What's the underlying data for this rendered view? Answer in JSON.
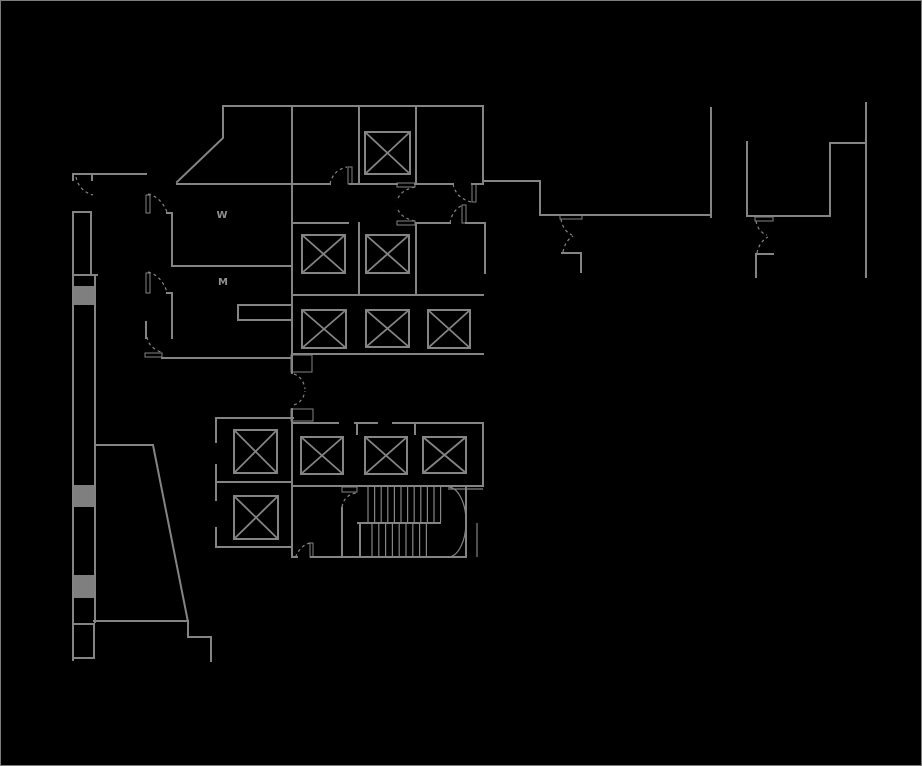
{
  "drawing": {
    "canvas": {
      "width": 922,
      "height": 766,
      "background": "#000000",
      "border_color": "#7c7c7c"
    },
    "style": {
      "wall_color": "#848484",
      "wall_width": 2,
      "thin_width": 1.2,
      "column_fill": "#7f7f7f",
      "dash_pattern": "3,3",
      "label_color": "#8f8f8f",
      "label_size": 10
    },
    "labels": [
      {
        "text": "W",
        "x": 222,
        "y": 218
      },
      {
        "text": "M",
        "x": 223,
        "y": 285
      }
    ],
    "walls": [
      [
        [
          177,
          182
        ],
        [
          223,
          138
        ],
        [
          223,
          106
        ],
        [
          483,
          106
        ]
      ],
      [
        [
          292,
          106
        ],
        [
          292,
          373
        ]
      ],
      [
        [
          359,
          106
        ],
        [
          359,
          184
        ]
      ],
      [
        [
          416,
          106
        ],
        [
          416,
          184
        ]
      ],
      [
        [
          483,
          106
        ],
        [
          483,
          183
        ]
      ],
      [
        [
          177,
          184
        ],
        [
          330,
          184
        ]
      ],
      [
        [
          350,
          184
        ],
        [
          397,
          184
        ]
      ],
      [
        [
          415,
          184
        ],
        [
          453,
          184
        ]
      ],
      [
        [
          472,
          184
        ],
        [
          483,
          184
        ]
      ],
      [
        [
          483,
          181
        ],
        [
          540,
          181
        ],
        [
          540,
          215
        ],
        [
          711,
          215
        ]
      ],
      [
        [
          711,
          108
        ],
        [
          711,
          217
        ]
      ],
      [
        [
          747,
          142
        ],
        [
          747,
          216
        ],
        [
          830,
          216
        ],
        [
          830,
          143
        ],
        [
          866,
          143
        ]
      ],
      [
        [
          866,
          103
        ],
        [
          866,
          277
        ]
      ],
      [
        [
          562,
          253
        ],
        [
          581,
          253
        ],
        [
          581,
          272
        ]
      ],
      [
        [
          773,
          254
        ],
        [
          756,
          254
        ],
        [
          756,
          277
        ]
      ],
      [
        [
          292,
          223
        ],
        [
          348,
          223
        ]
      ],
      [
        [
          417,
          223
        ],
        [
          450,
          223
        ]
      ],
      [
        [
          466,
          223
        ],
        [
          485,
          223
        ],
        [
          485,
          273
        ]
      ],
      [
        [
          359,
          223
        ],
        [
          359,
          295
        ]
      ],
      [
        [
          416,
          223
        ],
        [
          416,
          295
        ]
      ],
      [
        [
          292,
          295
        ],
        [
          483,
          295
        ]
      ],
      [
        [
          292,
          354
        ],
        [
          483,
          354
        ]
      ],
      [
        [
          167,
          213
        ],
        [
          172,
          213
        ],
        [
          172,
          266
        ]
      ],
      [
        [
          172,
          266
        ],
        [
          292,
          266
        ]
      ],
      [
        [
          167,
          293
        ],
        [
          172,
          293
        ],
        [
          172,
          338
        ]
      ],
      [
        [
          146,
          322
        ],
        [
          146,
          338
        ]
      ],
      [
        [
          162,
          358
        ],
        [
          292,
          358
        ]
      ],
      [
        [
          292,
          305
        ],
        [
          238,
          305
        ],
        [
          238,
          320
        ],
        [
          292,
          320
        ]
      ],
      [
        [
          73,
          180
        ],
        [
          73,
          174
        ],
        [
          92,
          174
        ],
        [
          92,
          180
        ]
      ],
      [
        [
          92,
          174
        ],
        [
          146,
          174
        ]
      ],
      [
        [
          73,
          212
        ],
        [
          91,
          212
        ]
      ],
      [
        [
          73,
          212
        ],
        [
          73,
          660
        ]
      ],
      [
        [
          91,
          212
        ],
        [
          91,
          275
        ]
      ],
      [
        [
          73,
          275
        ],
        [
          97,
          275
        ]
      ],
      [
        [
          95,
          275
        ],
        [
          95,
          622
        ]
      ],
      [
        [
          73,
          624
        ],
        [
          94,
          624
        ]
      ],
      [
        [
          94,
          624
        ],
        [
          94,
          658
        ]
      ],
      [
        [
          73,
          658
        ],
        [
          94,
          658
        ]
      ],
      [
        [
          95,
          445
        ],
        [
          153,
          445
        ]
      ],
      [
        [
          153,
          445
        ],
        [
          188,
          622
        ]
      ],
      [
        [
          94,
          621
        ],
        [
          188,
          621
        ]
      ],
      [
        [
          188,
          621
        ],
        [
          188,
          637
        ],
        [
          211,
          637
        ],
        [
          211,
          661
        ]
      ],
      [
        [
          293,
          418
        ],
        [
          216,
          418
        ],
        [
          216,
          442
        ]
      ],
      [
        [
          216,
          465
        ],
        [
          216,
          500
        ]
      ],
      [
        [
          216,
          528
        ],
        [
          216,
          547
        ],
        [
          292,
          547
        ]
      ],
      [
        [
          216,
          482
        ],
        [
          292,
          482
        ]
      ],
      [
        [
          292,
          409
        ],
        [
          292,
          557
        ]
      ],
      [
        [
          292,
          423
        ],
        [
          338,
          423
        ]
      ],
      [
        [
          355,
          423
        ],
        [
          377,
          423
        ]
      ],
      [
        [
          393,
          423
        ],
        [
          483,
          423
        ]
      ],
      [
        [
          357,
          423
        ],
        [
          357,
          434
        ]
      ],
      [
        [
          415,
          423
        ],
        [
          415,
          434
        ]
      ],
      [
        [
          483,
          423
        ],
        [
          483,
          486
        ]
      ],
      [
        [
          292,
          486
        ],
        [
          483,
          486
        ]
      ],
      [
        [
          292,
          557
        ],
        [
          297,
          557
        ]
      ],
      [
        [
          311,
          557
        ],
        [
          466,
          557
        ]
      ],
      [
        [
          466,
          486
        ],
        [
          466,
          557
        ]
      ],
      [
        [
          342,
          508
        ],
        [
          342,
          557
        ]
      ],
      [
        [
          358,
          523
        ],
        [
          440,
          523
        ]
      ],
      [
        [
          360,
          523
        ],
        [
          360,
          557
        ]
      ]
    ],
    "thin_lines": [
      [
        [
          448,
          489
        ],
        [
          483,
          489
        ]
      ],
      [
        [
          477,
          523
        ],
        [
          477,
          557
        ]
      ]
    ],
    "door_frames": [
      [
        146,
        195,
        4,
        18
      ],
      [
        146,
        273,
        4,
        20
      ],
      [
        145,
        353,
        17,
        4
      ],
      [
        348,
        167,
        4,
        17
      ],
      [
        472,
        184,
        4,
        18
      ],
      [
        462,
        205,
        4,
        18
      ],
      [
        397,
        183,
        18,
        4
      ],
      [
        397,
        221,
        18,
        4
      ],
      [
        291,
        355,
        21,
        17
      ],
      [
        291,
        409,
        22,
        12
      ],
      [
        560,
        215,
        22,
        4
      ],
      [
        755,
        217,
        18,
        4
      ],
      [
        342,
        487,
        15,
        5
      ],
      [
        310,
        543,
        3,
        14
      ]
    ],
    "columns": [
      [
        73,
        286,
        22,
        19
      ],
      [
        73,
        485,
        22,
        22
      ],
      [
        73,
        575,
        22,
        23
      ]
    ],
    "elevators": [
      [
        365,
        132,
        45,
        42
      ],
      [
        302,
        235,
        43,
        38
      ],
      [
        366,
        235,
        43,
        38
      ],
      [
        302,
        310,
        44,
        38
      ],
      [
        366,
        310,
        43,
        37
      ],
      [
        428,
        310,
        42,
        38
      ],
      [
        234,
        430,
        43,
        43
      ],
      [
        234,
        496,
        44,
        43
      ],
      [
        301,
        437,
        42,
        37
      ],
      [
        365,
        437,
        42,
        37
      ],
      [
        423,
        437,
        43,
        36
      ]
    ],
    "door_arcs_dashed": [
      "M 76 177 Q 79 191 93 195",
      "M 148 194 Q 161 197 167 212",
      "M 148 272 Q 161 275 167 292",
      "M 147 337 Q 149 348 161 352",
      "M 330 184 Q 333 170 347 167",
      "M 453 184 Q 456 198 471 202",
      "M 450 223 Q 452 211 461 206",
      "M 415 187 Q 400 190 397 201",
      "M 415 221 Q 400 218 397 207",
      "M 294 374 Q 303 377 305 389",
      "M 294 405 Q 303 402 305 391",
      "M 561 219 Q 563 231 572 235",
      "M 563 252 Q 565 241 573 236",
      "M 756 221 Q 758 232 767 235",
      "M 757 253 Q 759 242 768 237",
      "M 342 507 Q 344 495 356 493",
      "M 310 543 Q 301 545 296 556"
    ],
    "door_arcs_solid": [
      "M 448 487 A 18 35 0 0 1 448 557"
    ],
    "stairs": [
      {
        "x0": 368,
        "dx": 6.6,
        "n": 11,
        "y1": 487,
        "y2": 522
      },
      {
        "x0": 372,
        "dx": 6.8,
        "n": 8,
        "y1": 524,
        "y2": 556
      }
    ]
  }
}
